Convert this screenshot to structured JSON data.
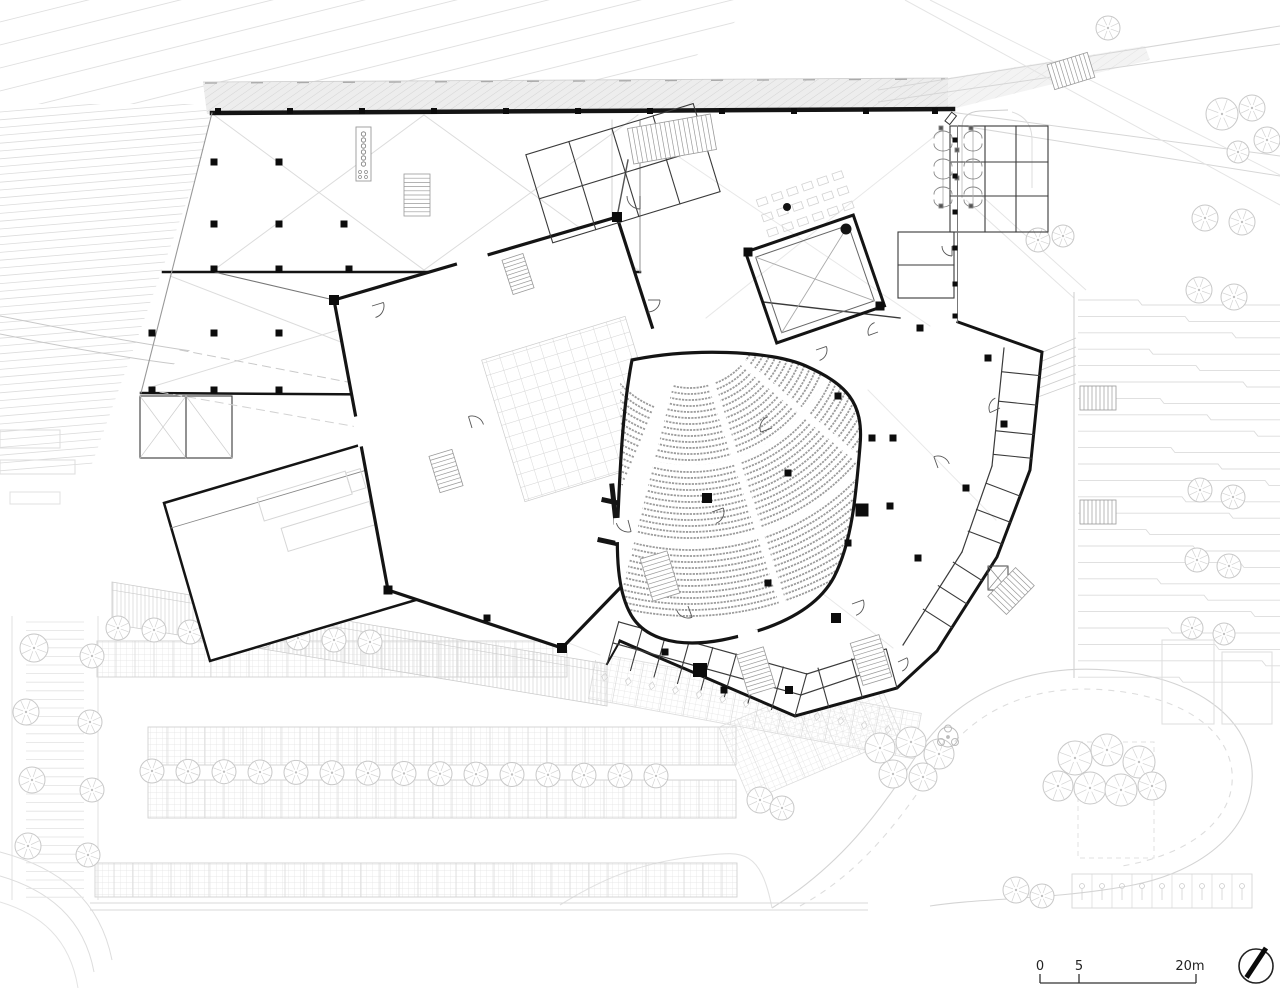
{
  "scale_bar": {
    "zero": "0",
    "five": "5",
    "max": "20m"
  },
  "colors": {
    "paper": "#ffffff",
    "wall": "#141414",
    "thin_wall": "#3a3a3a",
    "site_line": "#cccccc",
    "hatch": "#d8d8d8",
    "seat": "#9c9c9c",
    "text": "#222222"
  }
}
